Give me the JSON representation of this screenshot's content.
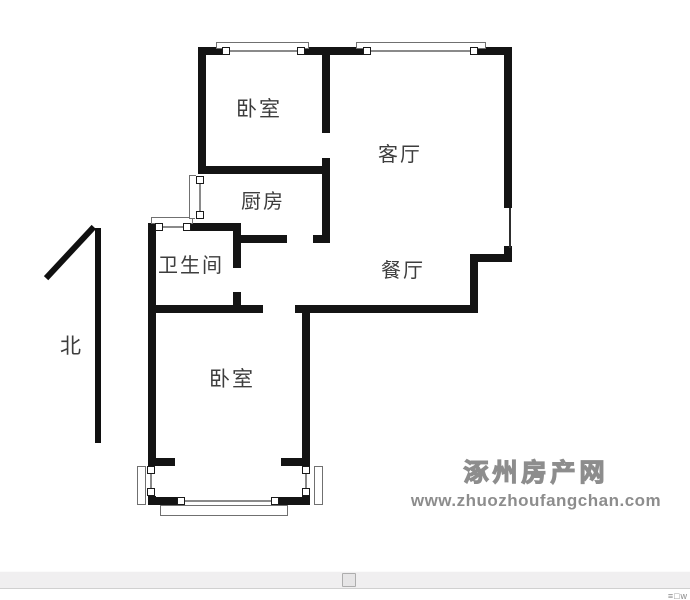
{
  "floor_plan": {
    "rooms": [
      {
        "name": "bedroom-top",
        "label": "卧室"
      },
      {
        "name": "living-room",
        "label": "客厅"
      },
      {
        "name": "kitchen",
        "label": "厨房"
      },
      {
        "name": "bathroom",
        "label": "卫生间"
      },
      {
        "name": "dining-room",
        "label": "餐厅"
      },
      {
        "name": "bedroom-bottom",
        "label": "卧室"
      }
    ],
    "compass": {
      "label": "北"
    }
  },
  "watermark": {
    "site_name": "涿州房产网",
    "site_url": "www.zhuozhoufangchan.com"
  },
  "status_bar": {
    "corner_glyphs": "≡□w"
  },
  "colors": {
    "wall": "#141414",
    "window_line": "#8a8a8a",
    "label": "#3d3d3d",
    "watermark_gray": "#8d8d8d",
    "scrollbar_track": "#f0eff0",
    "scrollbar_thumb": "#e6e5e6"
  }
}
